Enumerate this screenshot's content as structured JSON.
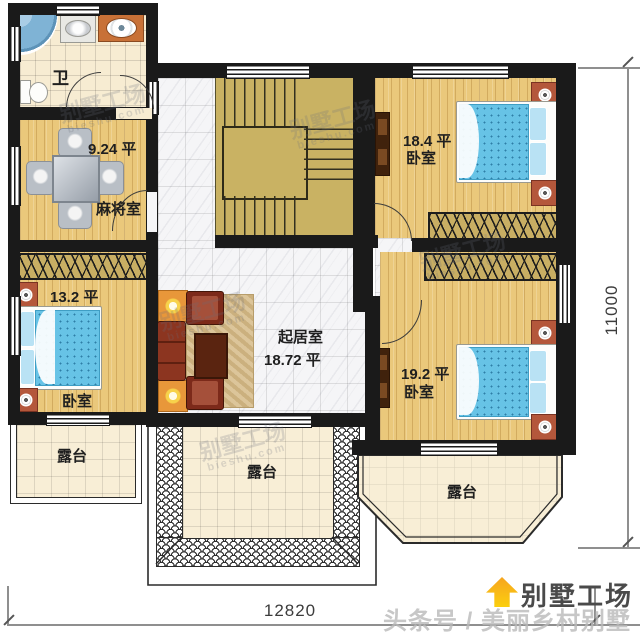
{
  "rooms": {
    "bathroom": {
      "label": "卫"
    },
    "mahjong": {
      "area": "9.24 平",
      "label": "麻将室"
    },
    "bedroom_left": {
      "area": "13.2 平",
      "label": "卧室"
    },
    "bedroom_top_right": {
      "area": "18.4 平",
      "label": "卧室"
    },
    "living": {
      "label": "起居室",
      "area": "18.72 平"
    },
    "bedroom_bottom_right": {
      "area": "19.2 平",
      "label": "卧室"
    },
    "terrace_left": {
      "label": "露台"
    },
    "terrace_center": {
      "label": "露台"
    },
    "terrace_bay": {
      "label": "露台"
    }
  },
  "dimensions": {
    "width": "12820",
    "height": "11000"
  },
  "branding": {
    "logo": "别墅工场",
    "byline": "头条号 / 美丽乡村别墅"
  },
  "watermark": {
    "name": "别墅工场",
    "site": "bieshu.com"
  },
  "colors": {
    "wall": "#1a1a1a",
    "wood_floor": "#eac87b",
    "stair": "#c9b263",
    "marble": "#f5f5f7",
    "bathroom_tile": "#f7ecd2",
    "terrace_tile": "#f8eed6",
    "bed_blue": "#67c3e6",
    "pillow_blue": "#b9e2f4",
    "sofa_red": "#7c2a1a",
    "nightstand": "#b4573b",
    "lamp_orange": "#e8973a",
    "logo_orange": "#f6a41f",
    "dimension_line": "#8f8f8f"
  }
}
